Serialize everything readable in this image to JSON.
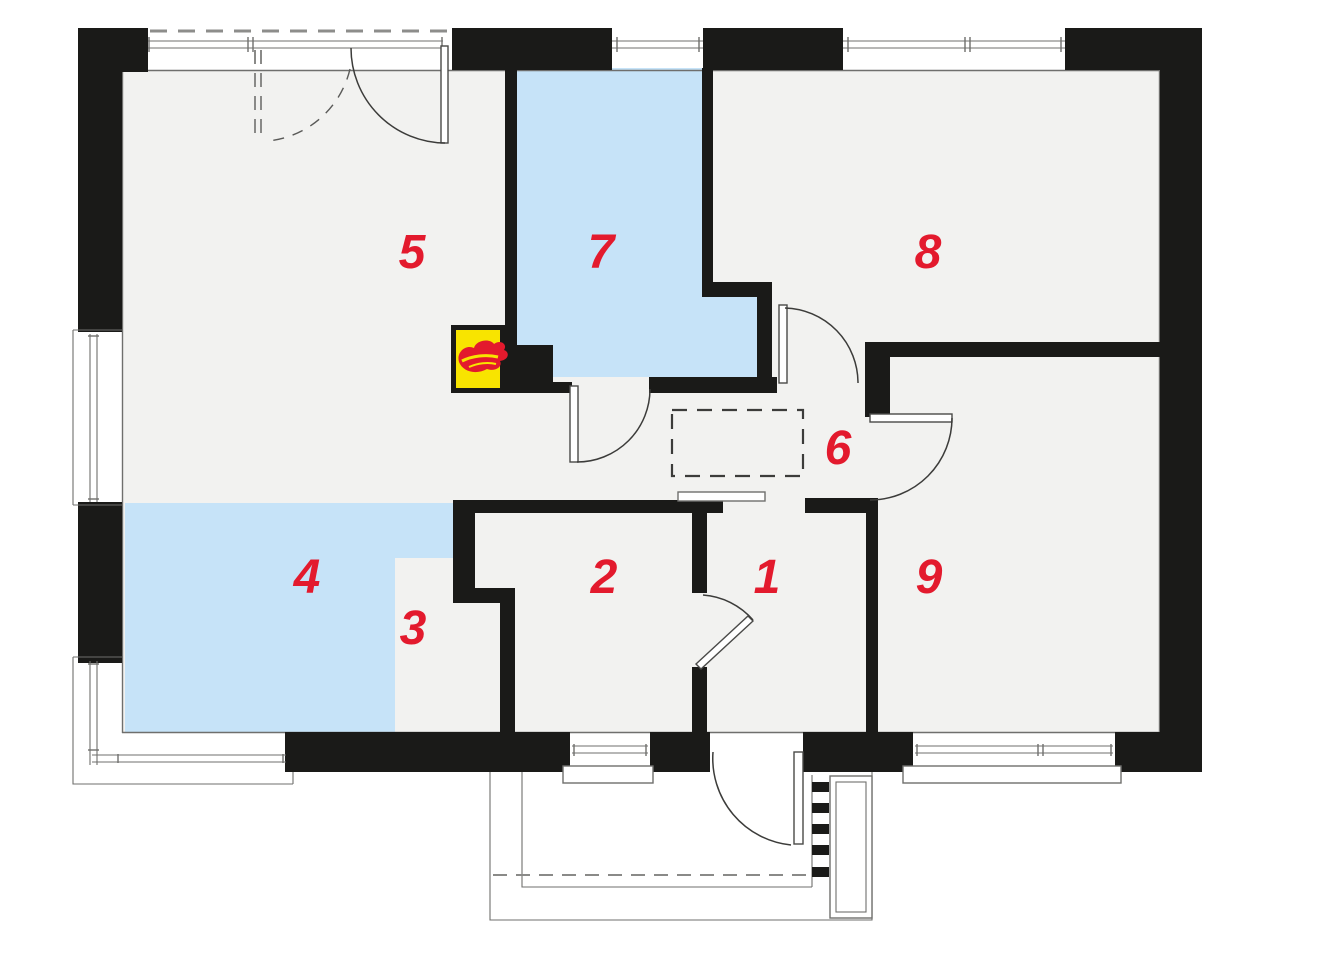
{
  "plan": {
    "rooms": [
      {
        "number": "1"
      },
      {
        "number": "2"
      },
      {
        "number": "3"
      },
      {
        "number": "4"
      },
      {
        "number": "5"
      },
      {
        "number": "6"
      },
      {
        "number": "7"
      },
      {
        "number": "8"
      },
      {
        "number": "9"
      }
    ],
    "boiler": {
      "icon": "flame-icon"
    }
  },
  "colors": {
    "c-wall": "#1a1a18",
    "c-floor": "#f2f2f0",
    "c-blue": "#c6e3f8",
    "c-red": "#e31a2d",
    "c-yellow": "#f8e400",
    "c-line": "#6f6f6d",
    "c-dash": "#8d8d8b",
    "c-white": "#ffffff"
  }
}
